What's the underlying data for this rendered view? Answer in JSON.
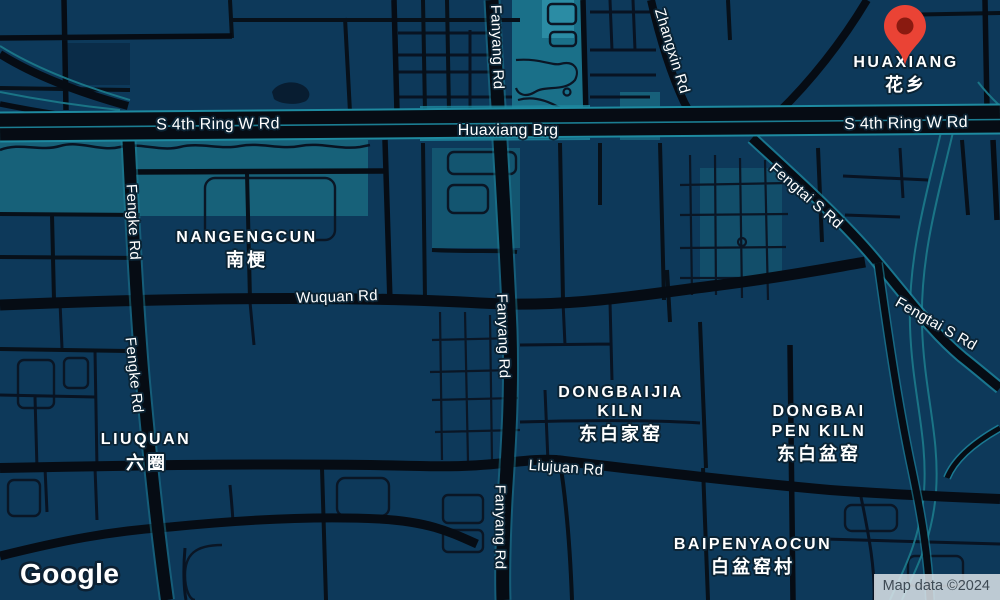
{
  "map": {
    "road_labels": {
      "ring_left": "S 4th Ring W Rd",
      "huaxiang_brg": "Huaxiang Brg",
      "ring_right": "S 4th Ring W Rd",
      "fengke_1": "Fengke Rd",
      "fengke_2": "Fengke Rd",
      "fanyang_1": "Fanyang Rd",
      "fanyang_2": "Fanyang Rd",
      "fanyang_3": "Fanyang Rd",
      "zhangxin": "Zhangxin Rd",
      "fengtai_1": "Fengtai S Rd",
      "fengtai_2": "Fengtai S Rd",
      "wuquan": "Wuquan Rd",
      "liujuan": "Liujuan Rd"
    },
    "place_labels": {
      "huaxiang": {
        "en": "HUAXIANG",
        "zh": "花乡"
      },
      "nangengcun": {
        "en": "NANGENGCUN",
        "zh": "南梗"
      },
      "liuquan": {
        "en": "LIUQUAN",
        "zh": "六圈"
      },
      "dongbaijia_kiln": {
        "line1": "DONGBAIJIA",
        "line2": "KILN",
        "zh": "东白家窑"
      },
      "dongbai_pen_kiln": {
        "line1": "DONGBAI",
        "line2": "PEN KILN",
        "zh": "东白盆窑"
      },
      "baipenyaocun": {
        "en": "BAIPENYAOCUN",
        "zh": "白盆窑村"
      }
    },
    "logo_text": "Google",
    "attribution_text": "Map data ©2024",
    "marker": {
      "semantic": "dropped-location-pin",
      "fill": "#EA4335",
      "hole": "#8A1A10"
    },
    "colors": {
      "block": "#0d395a",
      "road": "#060c14",
      "highway_casing": "#1e8aa0",
      "park_teal": "#176179",
      "label_text": "#ffffff",
      "attribution_bg": "#dde4e9",
      "attribution_text": "#3e4a54"
    }
  }
}
